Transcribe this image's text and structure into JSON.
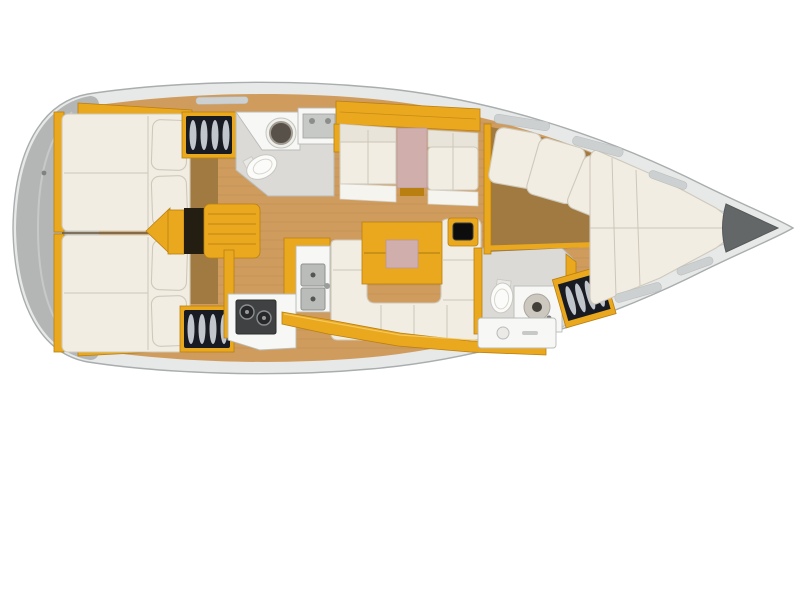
{
  "meta": {
    "title": "Sailboat interior layout plan, top view, bow pointing right",
    "type": "boat-floor-plan"
  },
  "colors": {
    "hull_fill": "#e7e8e8",
    "hull_line": "#a9adad",
    "deck_white": "#f5f6f5",
    "deck_line": "#c7caca",
    "stern_gray": "#b4b6b6",
    "wood": "#cf9c5e",
    "wood_dark": "#a07a40",
    "wood_deep": "#8f6a35",
    "yellow": "#eaa81f",
    "yellow_dark": "#b97f10",
    "mattress": "#f1ede2",
    "mattress_edge": "#cfc9ba",
    "pink": "#d0aeac",
    "white_fixture": "#f7f7f5",
    "fixture_line": "#b9bcb9",
    "gray_floor": "#dcdad6",
    "locker_dark": "#181b22",
    "locker_stripe": "#dfe3ea",
    "stove": "#3f4142",
    "burner": "#26282a",
    "sink_dark": "#57514a",
    "anchor": "#646767",
    "hatch_gray": "#cdd0d0",
    "instrument": "#0d0d0d"
  },
  "areas": [
    {
      "id": "aft-cabin-port",
      "label": "aft double cabin (top)"
    },
    {
      "id": "aft-cabin-starboard",
      "label": "aft double cabin (bottom)"
    },
    {
      "id": "companionway",
      "label": "companionway steps"
    },
    {
      "id": "aft-head",
      "label": "aft head with toilet and washbasin"
    },
    {
      "id": "port-settee",
      "label": "straight settee with table"
    },
    {
      "id": "salon",
      "label": "salon U-settee and table"
    },
    {
      "id": "galley",
      "label": "galley with stove and double sink"
    },
    {
      "id": "forward-head",
      "label": "forward head with toilet and vanity"
    },
    {
      "id": "forward-cabin",
      "label": "forward cabin with sofa and V-berth"
    },
    {
      "id": "anchor-locker",
      "label": "anchor locker at bow"
    }
  ],
  "fixtures": [
    "double-berth",
    "pillows",
    "hanging-locker-shelves",
    "companionway-steps",
    "toilet",
    "round-washbasin",
    "galley-sink-console",
    "double-square-sink",
    "two-burner-stove",
    "settee-table-pink-inset",
    "salon-table-pink-inset",
    "instrument-screen",
    "vanity-sink",
    "drawer-unit",
    "sofa-cushions",
    "v-berth-mattress",
    "deck-hatches",
    "anchor-locker-triangle"
  ]
}
